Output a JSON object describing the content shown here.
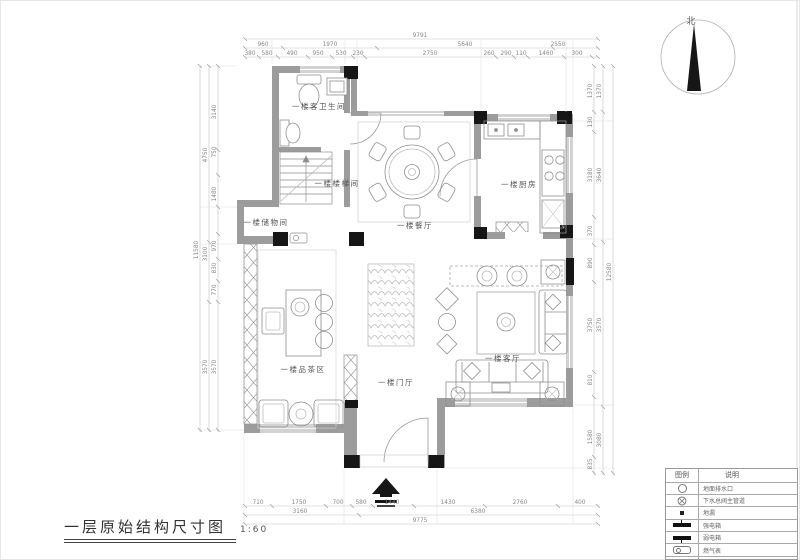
{
  "title": {
    "name": "一层原始结构尺寸图",
    "scale": "1:60"
  },
  "compass": {
    "north_label": "北"
  },
  "rooms": {
    "guest_bathroom": "一楼客卫生间",
    "stairwell": "一楼楼梯间",
    "storage": "一楼储物间",
    "dining": "一楼餐厅",
    "kitchen": "一楼厨房",
    "tea_area": "一楼品茶区",
    "foyer": "一楼门厅",
    "living": "一楼客厅"
  },
  "legend": {
    "col_symbol": "图例",
    "col_desc": "说明",
    "rows": [
      {
        "icon": "drain-circle-icon",
        "desc": "地面排水口"
      },
      {
        "icon": "drain-cross-icon",
        "desc": "下水总阀主管道"
      },
      {
        "icon": "floor-drain-icon",
        "desc": "地漏"
      },
      {
        "icon": "strong-power-box-icon",
        "desc": "强电箱"
      },
      {
        "icon": "weak-power-box-icon",
        "desc": "弱电箱"
      },
      {
        "icon": "gas-meter-icon",
        "desc": "燃气表"
      },
      {
        "icon": "wall-hatch-icon",
        "desc": "墙"
      }
    ]
  },
  "dimensions": {
    "top": {
      "overall": "9791",
      "mid": [
        "960",
        "1970",
        "5640",
        "2550"
      ],
      "inner": [
        "380",
        "580",
        "490",
        "950",
        "530",
        "230",
        "2750",
        "260",
        "290",
        "110",
        "1460",
        "300"
      ]
    },
    "bottom": {
      "overall": "9775",
      "mid": [
        "3160",
        "6380"
      ],
      "inner": [
        "710",
        "1750",
        "700",
        "580",
        "1440",
        "1430",
        "2760",
        "400"
      ]
    },
    "left": {
      "overall": "11580",
      "mid": [
        "4750",
        "3100",
        "3570"
      ],
      "inner": [
        "3140",
        "750",
        "1480",
        "970",
        "830",
        "770",
        "3570"
      ]
    },
    "right": {
      "overall": "12580",
      "mid": [
        "1370",
        "3640",
        "3570",
        "3080"
      ],
      "inner": [
        "1370",
        "130",
        "3180",
        "370",
        "890",
        "3750",
        "810",
        "1580",
        "835"
      ]
    }
  }
}
